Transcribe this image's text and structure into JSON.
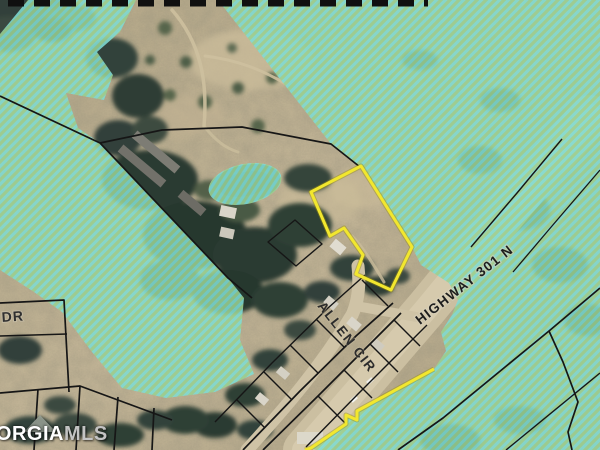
{
  "map": {
    "road_labels": {
      "allen_cir": "ALLEN CIR",
      "highway": "HIGHWAY 301 N",
      "dr": "DR"
    },
    "watermark": {
      "brand_primary": "GEORGIA",
      "brand_secondary": "MLS"
    },
    "colors": {
      "parcel_highlight": "#f2e72e",
      "flood_hatch_cyan": "#7fdcd4",
      "flood_hatch_green": "#9ad191",
      "parcel_boundary": "#161616",
      "ground_tan": "#bfb294",
      "pond_blue": "#39606e"
    }
  }
}
